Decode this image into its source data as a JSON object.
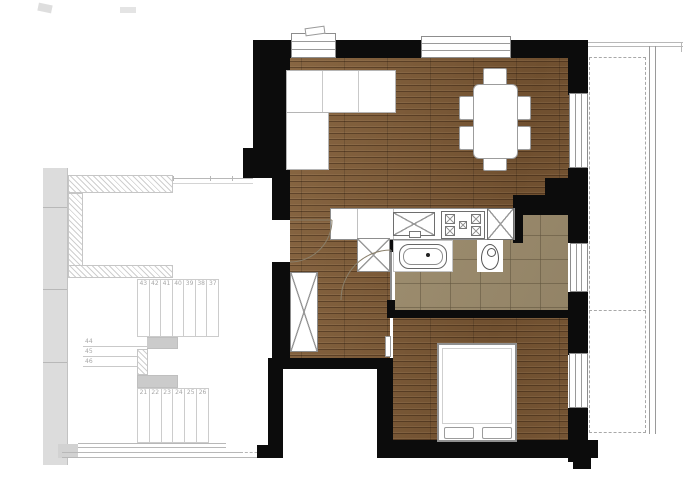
{
  "floor_plan": {
    "colors": {
      "wall": "#0c0c0c",
      "wood_floor": "#7b5937",
      "tile_floor": "#a29273",
      "neighbor_gray": "#cbcbcb",
      "line_gray": "#9a9a9a"
    },
    "stairs": {
      "upper_flight_numbers": [
        "43",
        "42",
        "41",
        "40",
        "39",
        "38",
        "37"
      ],
      "landing_numbers": [
        "44",
        "45",
        "46"
      ],
      "lower_flight_numbers": [
        "21",
        "22",
        "23",
        "24",
        "25",
        "26"
      ]
    },
    "symbols": {
      "sofa": "sectional-sofa",
      "dining": "dining-table-six-chairs",
      "kitchen_sink": "crossed-sink-unit",
      "stove": "four-burner-stove",
      "tall_cabinet": "crossed-cabinet",
      "hall_closet": "crossed-closet",
      "wardrobe": "crossed-wardrobe",
      "vanity": "bathroom-sink-vanity",
      "toilet": "toilet",
      "bed": "double-bed-with-pillows",
      "windows": "window",
      "doors": "door-swing-arc",
      "balcony": "dashed-balcony-outline",
      "staircase": "neighbor-staircase"
    }
  }
}
